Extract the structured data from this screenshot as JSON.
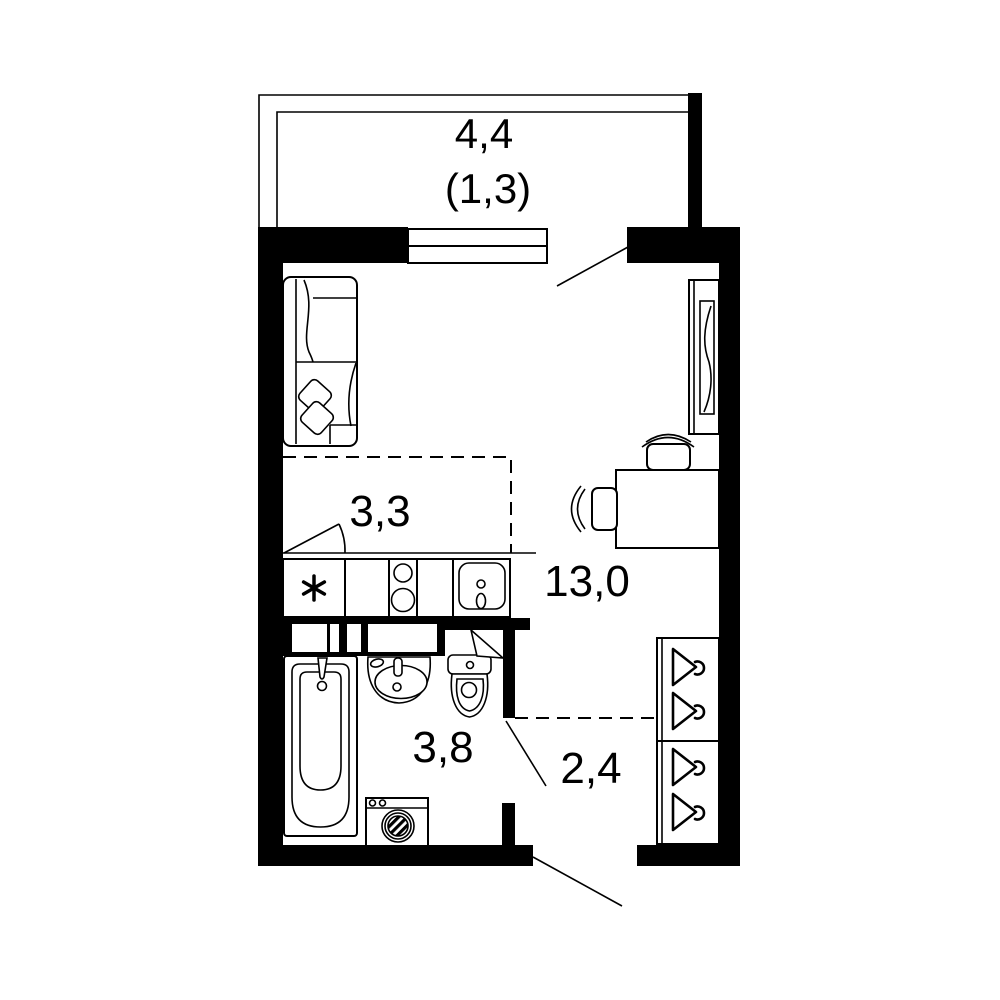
{
  "plan_type": "studio-apartment-floor-plan",
  "rooms": [
    {
      "id": "balcony",
      "area": "4,4",
      "reduced_area": "(1,3)"
    },
    {
      "id": "living-room",
      "area": "13,0"
    },
    {
      "id": "kitchen-zone",
      "area": "3,3"
    },
    {
      "id": "bathroom",
      "area": "3,8"
    },
    {
      "id": "hallway",
      "area": "2,4"
    }
  ],
  "furniture_symbols": [
    "sofa",
    "pillows",
    "tv-wardrobe-unit",
    "desk",
    "chair",
    "chair",
    "kitchen-counter",
    "fridge-asterisk",
    "stove-two-burners",
    "kitchen-sink",
    "bathtub",
    "washbasin",
    "toilet",
    "washing-machine",
    "hanger-wardrobe",
    "window",
    "balcony-railing",
    "door-swings"
  ],
  "colors": {
    "walls": "#000000",
    "lines": "#000000",
    "background": "#ffffff"
  }
}
